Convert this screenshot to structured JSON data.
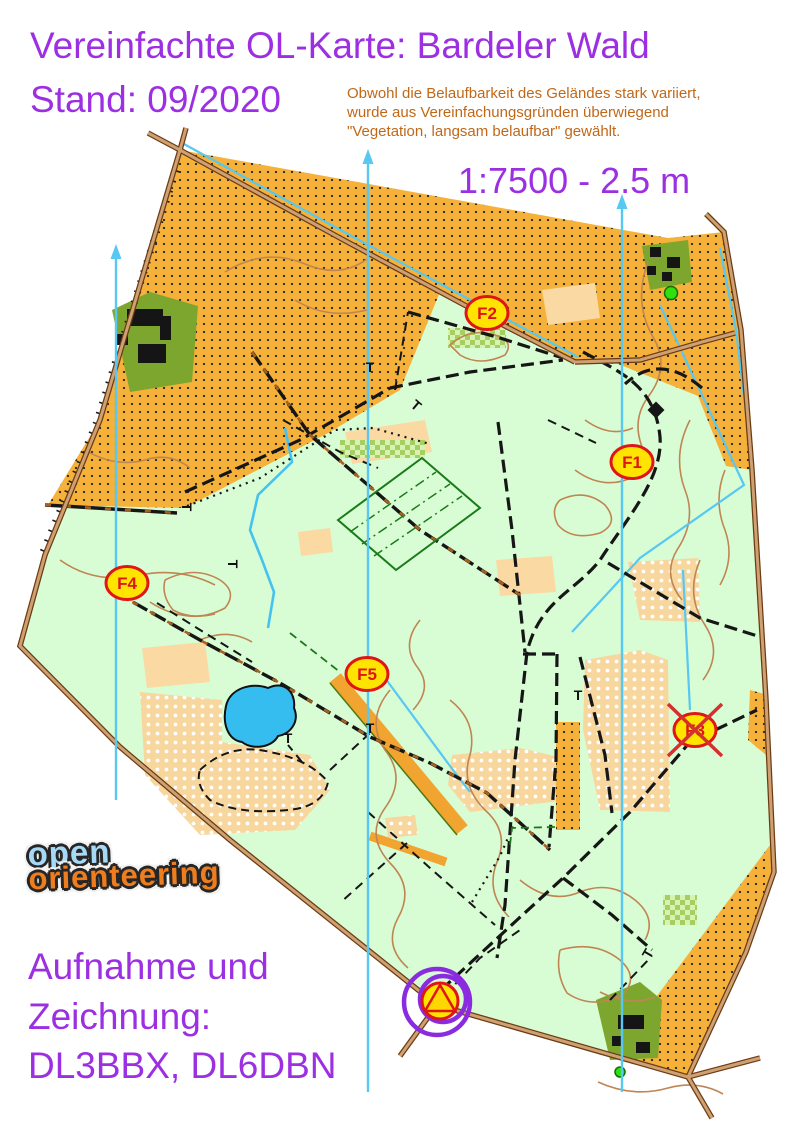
{
  "header": {
    "title": "Vereinfachte OL-Karte: Bardeler Wald",
    "stand": "Stand: 09/2020",
    "scale": "1:7500 - 2.5 m",
    "note_lines": [
      "Obwohl die Belaufbarkeit des Geländes stark variiert,",
      "wurde aus Vereinfachungsgründen überwiegend",
      "\"Vegetation, langsam belaufbar\" gewählt."
    ]
  },
  "logo": {
    "line1": "open",
    "line2": "orienteering"
  },
  "credits": {
    "lines": [
      "Aufnahme und",
      "Zeichnung:",
      "DL3BBX, DL6DBN"
    ]
  },
  "map": {
    "controls": [
      {
        "label": "F1",
        "x": 632,
        "y": 462,
        "crossed": false
      },
      {
        "label": "F2",
        "x": 487,
        "y": 313,
        "crossed": false
      },
      {
        "label": "F3",
        "x": 695,
        "y": 730,
        "crossed": true
      },
      {
        "label": "F4",
        "x": 127,
        "y": 583,
        "crossed": false
      },
      {
        "label": "F5",
        "x": 367,
        "y": 674,
        "crossed": false
      }
    ],
    "start_finish": {
      "x": 440,
      "y": 1001
    },
    "north_lines": [
      {
        "x": 116,
        "y1": 255,
        "y2": 800
      },
      {
        "x": 368,
        "y1": 160,
        "y2": 1092
      },
      {
        "x": 622,
        "y1": 205,
        "y2": 1092
      }
    ],
    "t_marks": [
      [
        182,
        507,
        90
      ],
      [
        228,
        564,
        90
      ],
      [
        370,
        372,
        0
      ],
      [
        413,
        409,
        40
      ],
      [
        578,
        700,
        0
      ],
      [
        288,
        743,
        0
      ],
      [
        370,
        733,
        0
      ],
      [
        652,
        956,
        -60
      ]
    ]
  },
  "colors": {
    "purple": "#9d2fe3",
    "note-orange": "#c06818",
    "map-green": "#d8fdd4",
    "rough-orange": "#f5b13a",
    "pale-orange": "#fbd9a2",
    "olive": "#7da62e",
    "water-blue": "#35bdf0",
    "cyan": "#56c8f2",
    "road-brown": "#6b3c14",
    "road-fill": "#cfa072",
    "contour": "#c08552",
    "control-red": "#e01515",
    "control-yellow": "#ffe400",
    "logo-blue": "#a5d9f5",
    "logo-orange": "#ee7d1e"
  }
}
